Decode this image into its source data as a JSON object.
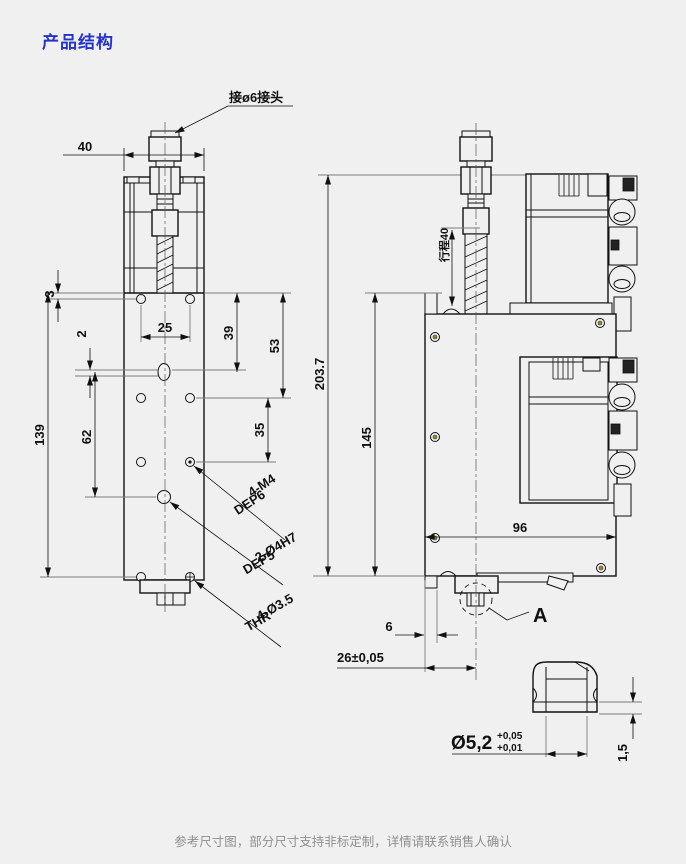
{
  "page": {
    "title": "产品结构",
    "footer": "参考尺寸图，部分尺寸支持非标定制，详情请联系销售人确认",
    "accent_color": "#2433cb",
    "background": "#f0f0f0"
  },
  "drawing": {
    "type": "technical-2d-cad-drawing",
    "labels": {
      "fitting": "接ø6接头",
      "m4a": "4-M4",
      "m4b": "DEP6",
      "h7a": "2-Ø4H7",
      "h7b": "DEP5",
      "thra": "4-Ø3.5",
      "thrb": "THR"
    },
    "front_dims": {
      "w40": "40",
      "o3": "3",
      "o2": "2",
      "p25": "25",
      "v39": "39",
      "v53": "53",
      "v62": "62",
      "v35": "35",
      "len139": "139"
    },
    "side_dims": {
      "h203": "203.7",
      "h145": "145",
      "stroke": "行程40",
      "w96": "96",
      "w6": "6",
      "w26": "26±0,05"
    },
    "detail_dims": {
      "name": "A",
      "dia": "Ø5,2",
      "tu": "+0,05",
      "tl": "+0,01",
      "g15": "1,5"
    }
  }
}
